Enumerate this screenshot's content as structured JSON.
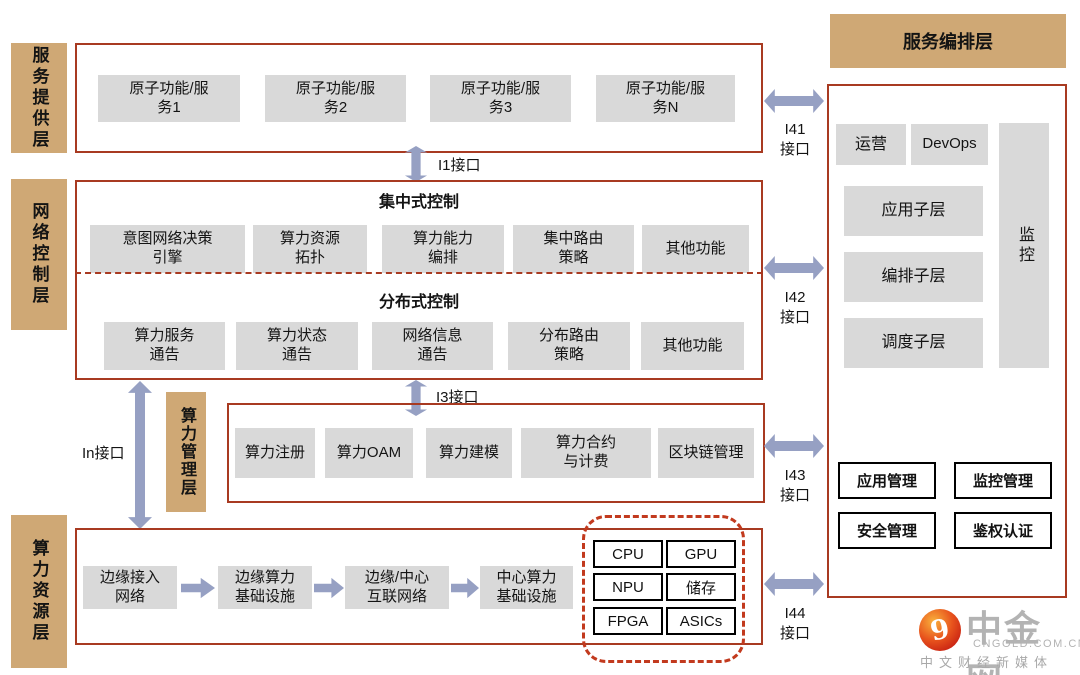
{
  "palette": {
    "tan": "#CFA875",
    "red_border": "#A83A21",
    "dashed_red": "#C23A1E",
    "arrow_blue": "#96A0C3",
    "box_gray": "#D9D9D9"
  },
  "layers": {
    "service": {
      "label": "服务提供层",
      "items": [
        "原子功能/服\n务1",
        "原子功能/服\n务2",
        "原子功能/服\n务3",
        "原子功能/服\n务N"
      ]
    },
    "network": {
      "label": "网络控制层",
      "centralized": {
        "title": "集中式控制",
        "items": [
          "意图网络决策\n引擎",
          "算力资源\n拓扑",
          "算力能力\n编排",
          "集中路由\n策略",
          "其他功能"
        ]
      },
      "distributed": {
        "title": "分布式控制",
        "items": [
          "算力服务\n通告",
          "算力状态\n通告",
          "网络信息\n通告",
          "分布路由\n策略",
          "其他功能"
        ]
      }
    },
    "management": {
      "label": "算力管理层",
      "items": [
        "算力注册",
        "算力OAM",
        "算力建模",
        "算力合约\n与计费",
        "区块链管理"
      ]
    },
    "resource": {
      "label": "算力资源层",
      "flow": [
        "边缘接入\n网络",
        "边缘算力\n基础设施",
        "边缘/中心\n互联网络",
        "中心算力\n基础设施"
      ],
      "chips": [
        "CPU",
        "GPU",
        "NPU",
        "储存",
        "FPGA",
        "ASICs"
      ]
    },
    "orchestration": {
      "header": "服务编排层",
      "ops": "运营",
      "devops": "DevOps",
      "sublayers": [
        "应用子层",
        "编排子层",
        "调度子层"
      ],
      "monitor": "监控",
      "management_boxes": [
        "应用管理",
        "监控管理",
        "安全管理",
        "鉴权认证"
      ]
    }
  },
  "interfaces": {
    "i1": "I1接口",
    "i3": "I3接口",
    "in": "In接口",
    "i41": "I41\n接口",
    "i42": "I42\n接口",
    "i43": "I43\n接口",
    "i44": "I44\n接口"
  },
  "logo": {
    "brand": "中金网",
    "domain": "CNGOLD.COM.CN",
    "tagline": "中文财经新媒体"
  }
}
